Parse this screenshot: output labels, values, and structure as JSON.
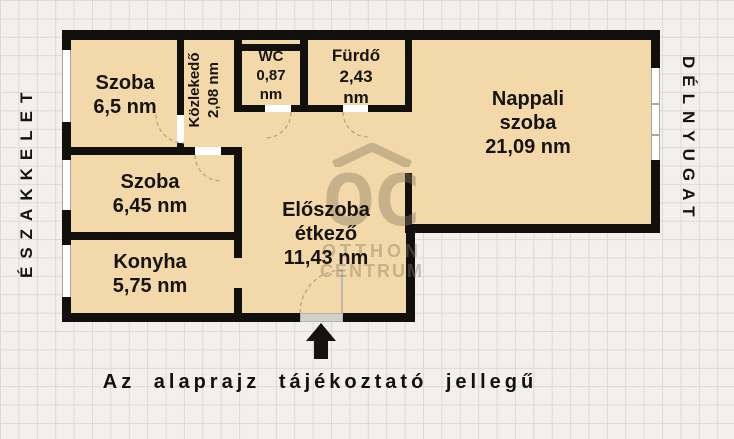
{
  "compass": {
    "left_label": "ÉSZAKKELET",
    "right_label": "DÉLNYUGAT"
  },
  "caption": "Az alaprajz tájékoztató jellegű",
  "rooms": {
    "szoba_felso": {
      "name": "Szoba",
      "area": "6,5 nm"
    },
    "kozlekedo": {
      "name": "Közlekedő",
      "area": "2,08 nm"
    },
    "wc": {
      "name": "WC",
      "area": "0,87",
      "unit": "nm"
    },
    "furdo": {
      "name": "Fürdő",
      "area": "2,43",
      "unit": "nm"
    },
    "nappali": {
      "name": "Nappali",
      "name2": "szoba",
      "area": "21,09 nm"
    },
    "szoba_also": {
      "name": "Szoba",
      "area": "6,45 nm"
    },
    "konyha": {
      "name": "Konyha",
      "area": "5,75 nm"
    },
    "eloszoba": {
      "name": "Előszoba",
      "name2": "étkező",
      "area": "11,43 nm"
    }
  },
  "watermark": {
    "monogram": "OC",
    "line1": "OTTHON",
    "line2": "CENTRUM"
  },
  "icons": {
    "entrance_arrow": "up-arrow",
    "watermark_roof": "roof-chevron"
  },
  "colors": {
    "room_fill": "#f3d9a9",
    "wall": "#12100d",
    "background": "#f1f0ec",
    "grid_line": "#dcdad4",
    "watermark": "#8b7b63",
    "door_arc": "#b4a489"
  }
}
